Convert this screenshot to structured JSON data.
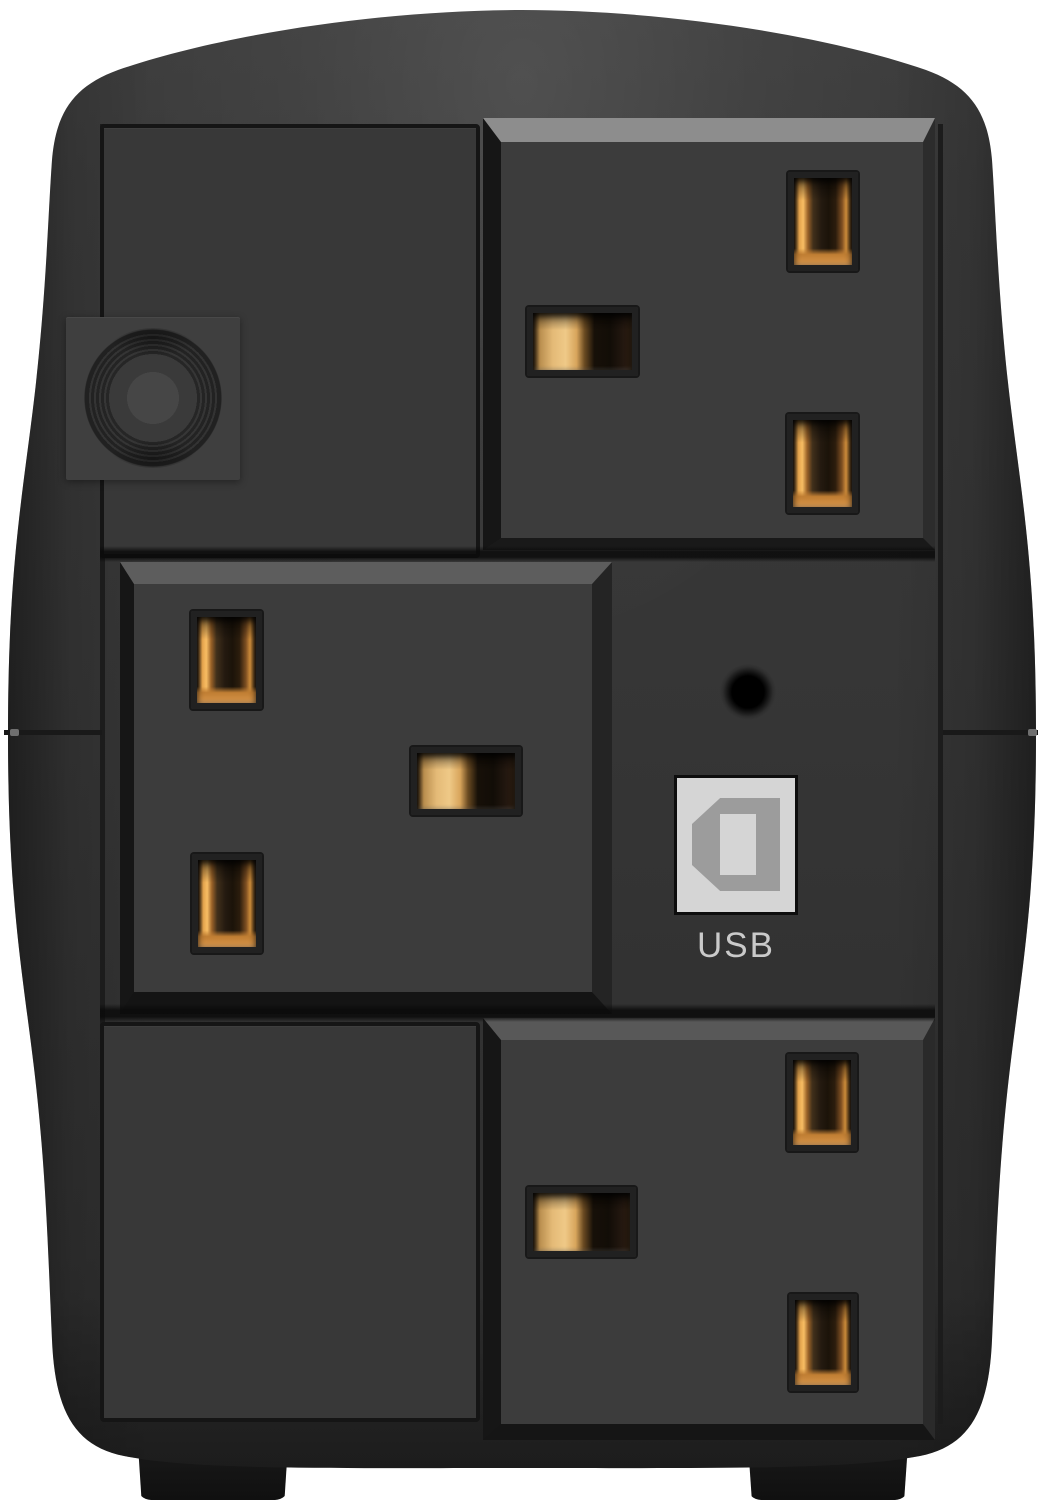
{
  "components": {
    "usb": {
      "icon": "usb-type-b-port-icon",
      "label": "USB"
    },
    "reset": {
      "icon": "reset-pinhole-icon"
    },
    "breaker": {
      "icon": "circuit-breaker-button-icon"
    },
    "outlets": [
      {
        "name": "outlet-top-right",
        "type": "uk-bs1363-socket",
        "pin_slots": 3
      },
      {
        "name": "outlet-middle-left",
        "type": "uk-bs1363-socket",
        "pin_slots": 3
      },
      {
        "name": "outlet-bottom-right",
        "type": "uk-bs1363-socket",
        "pin_slots": 3
      }
    ]
  },
  "colors": {
    "background": "#ffffff",
    "body_top": "#3e3e3e",
    "body_mid": "#353535",
    "body_bottom": "#282828",
    "panel_face": "#3c3c3c",
    "flat_panel_face": "#383838",
    "outline": "#151515",
    "bevel_top_bright": "#8d8d8d",
    "bevel_top_soft": "#5d5d5d",
    "bevel_dark": "#161616",
    "groove": "#1c1c1c",
    "slot_frame": "#212121",
    "brass_bright": "#f6bc63",
    "brass_mid": "#c98f44",
    "brass_deep": "#2a1b0d",
    "usb_plate": "#d5d5d5",
    "usb_glyph": "#9c9c9c",
    "usb_label": "#cacaca",
    "breaker_face": "#3f3f3f",
    "foot": "#171717"
  }
}
